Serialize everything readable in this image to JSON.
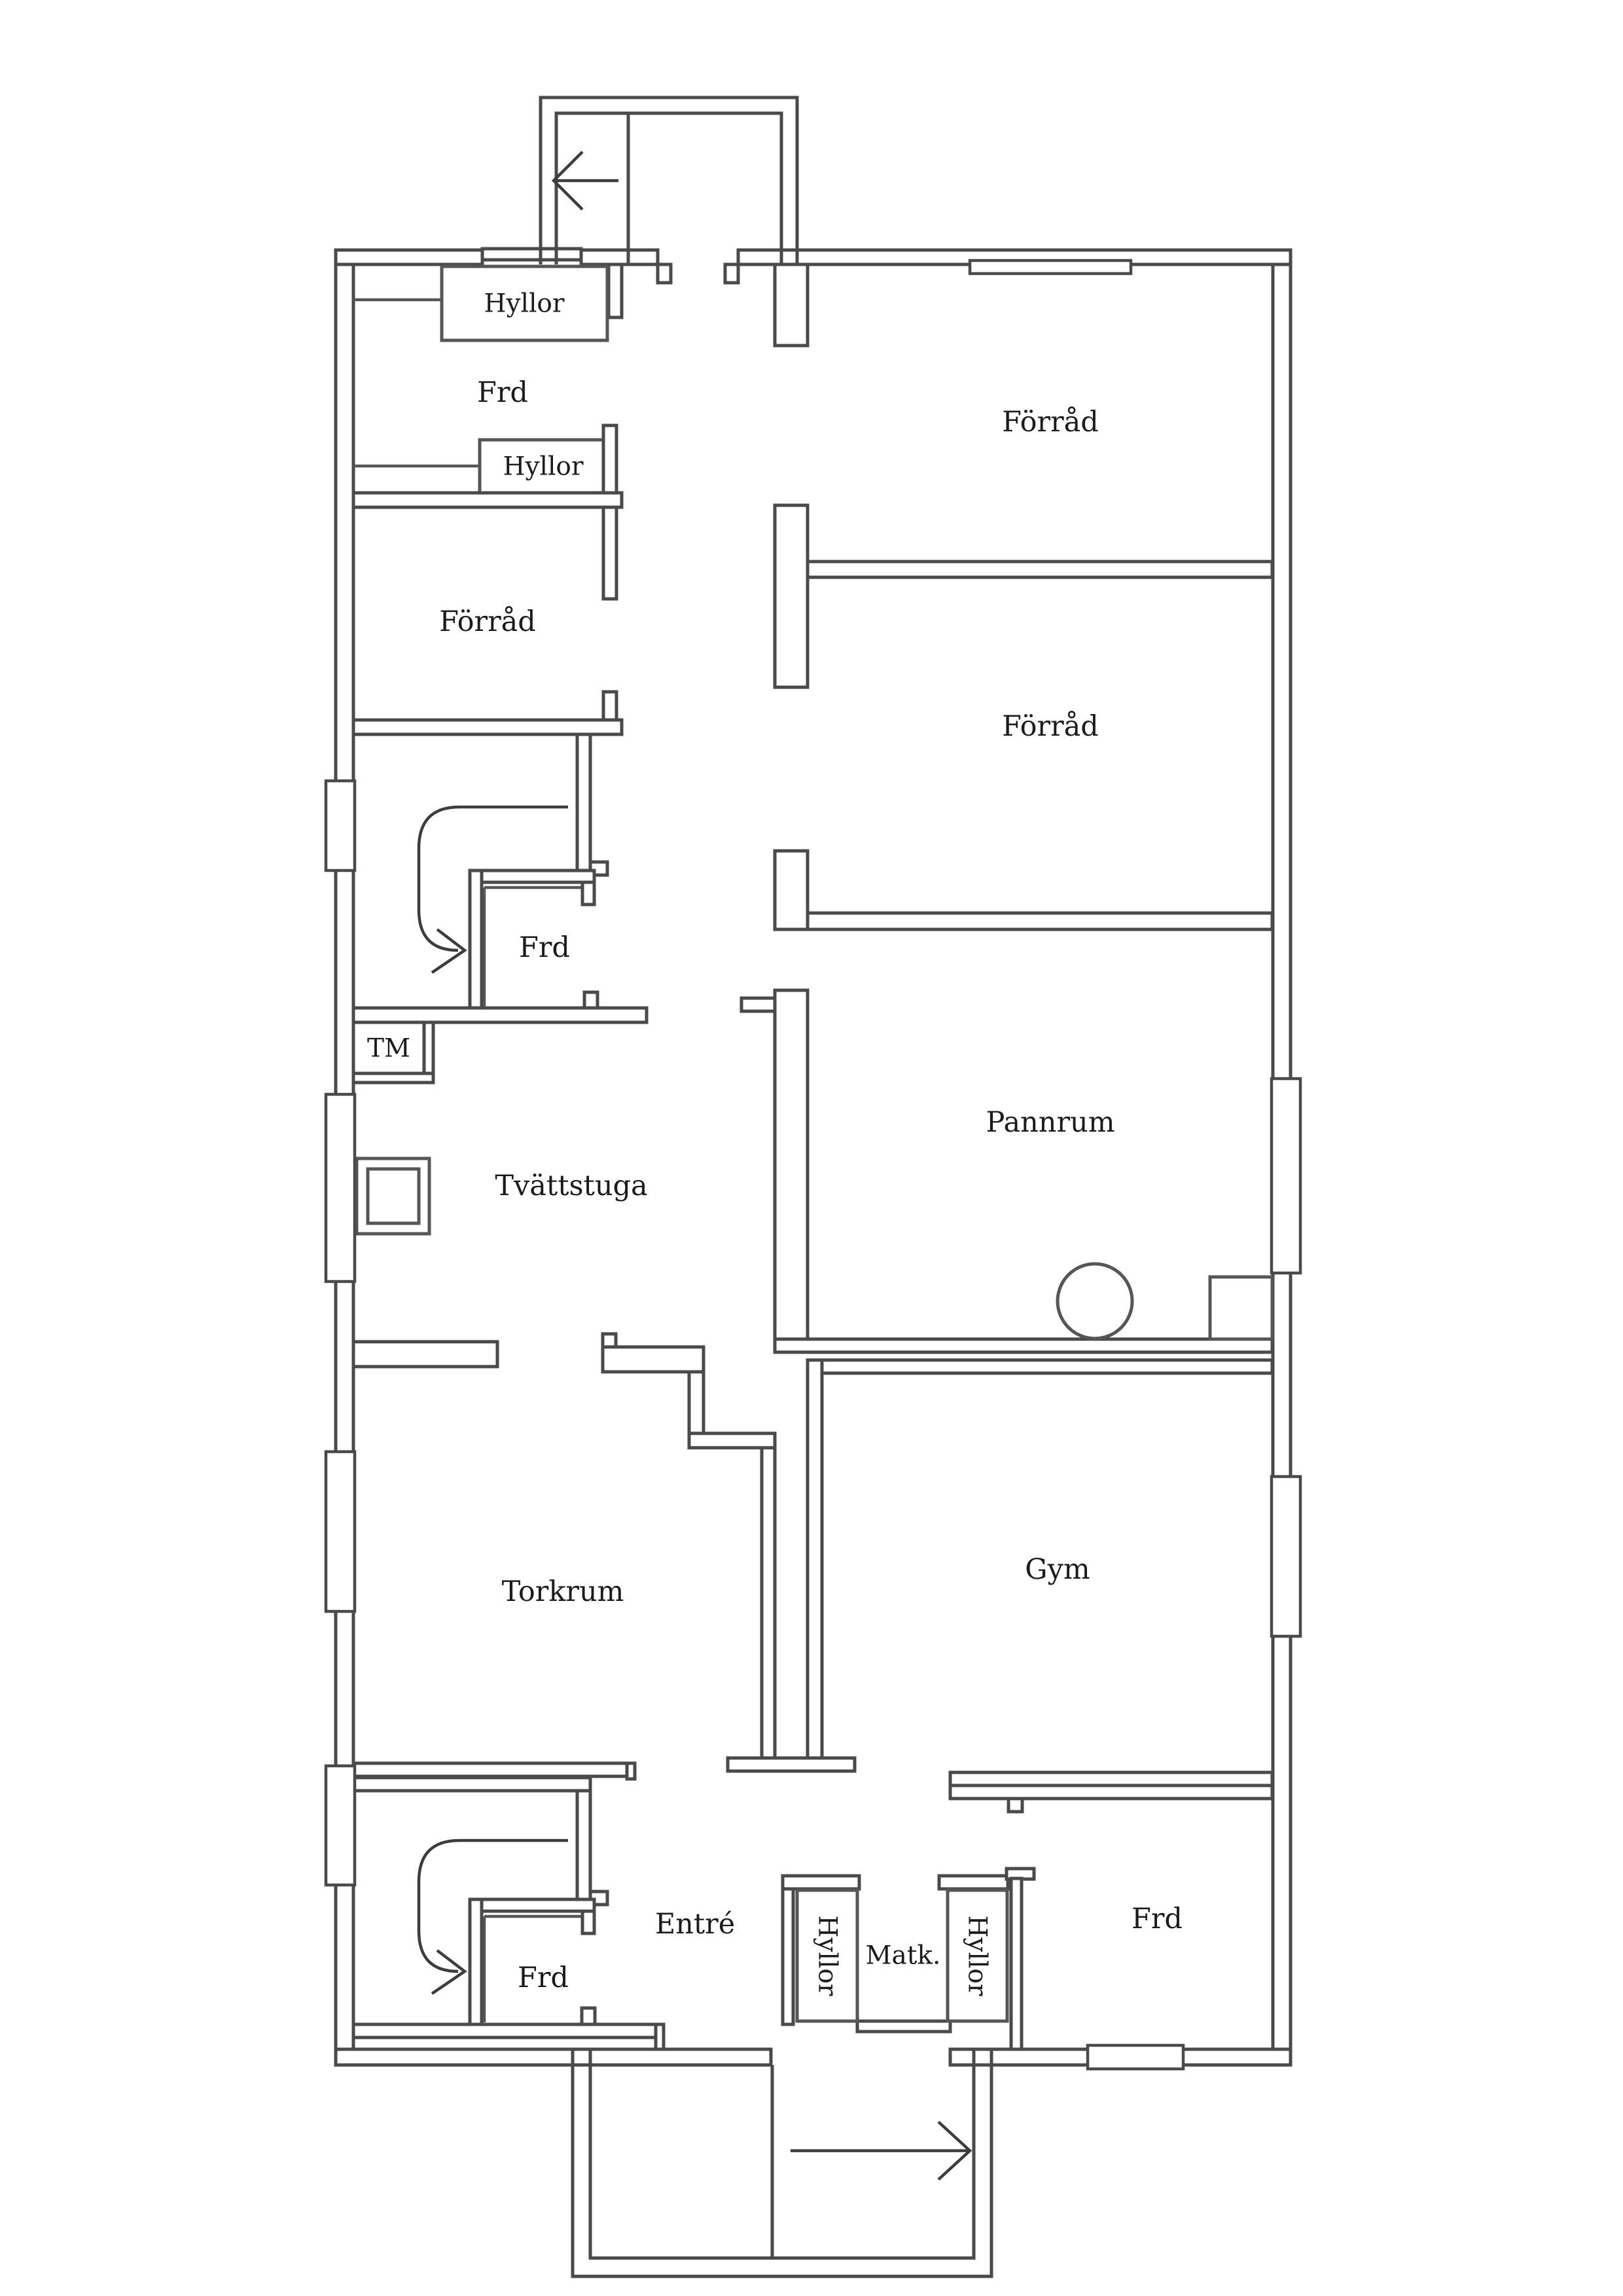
{
  "document": {
    "type": "basement-floor-plan",
    "background": "#ffffff"
  },
  "colors": {
    "wall": "#4a4a4a",
    "thin_line": "#565656",
    "text": "#1b1b1b"
  },
  "labels": {
    "hyllor_top": "Hyllor",
    "frd_topleft": "Frd",
    "hyllor_mid": "Hyllor",
    "forrad_left": "Förråd",
    "forrad_right_1": "Förråd",
    "forrad_right_2": "Förråd",
    "frd_stair_mid": "Frd",
    "tm": "TM",
    "tvattstuga": "Tvättstuga",
    "pannrum": "Pannrum",
    "torkrum": "Torkrum",
    "gym": "Gym",
    "entre": "Entré",
    "frd_stair_bottom": "Frd",
    "hyllor_bottom_left": "Hyllor",
    "matk": "Matk.",
    "hyllor_bottom_right": "Hyllor",
    "frd_bottom_right": "Frd"
  },
  "icons": {
    "stair_up_top": "arrow-left",
    "stair_up_bottom": "arrow-right",
    "stair_turn_mid": "curved-arrow-down-right",
    "stair_turn_bottom": "curved-arrow-down-right"
  }
}
